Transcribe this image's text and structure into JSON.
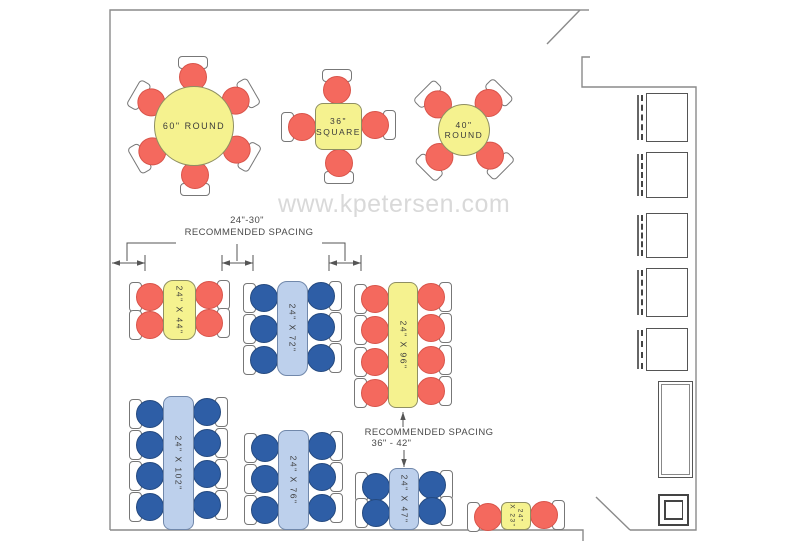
{
  "watermark": {
    "text": "www.kpetersen.com",
    "color": "#d9d9d9"
  },
  "annotations": {
    "top": {
      "line1": "24\"-30\"",
      "line2": "RECOMMENDED SPACING"
    },
    "bottom": {
      "line1": "RECOMMENDED SPACING",
      "line2": "36\" - 42\""
    }
  },
  "colors": {
    "table_yellow": "#f5f28f",
    "table_yellow_border": "#8f8f62",
    "table_blue": "#bdd0ec",
    "table_blue_border": "#7188ab",
    "chair_red": "#f4695e",
    "chair_red_border": "#d9544a",
    "chair_blue": "#2e5ea6",
    "chair_blue_border": "#24497f",
    "wall": "#8a8a8a",
    "dim": "#555555",
    "label": "#3a3a3a"
  },
  "tables": [
    {
      "id": "round-60",
      "shape": "circle",
      "x": 154,
      "y": 86,
      "w": 80,
      "h": 80,
      "color": "yellow",
      "chair_color": "red",
      "label_lines": [
        "60\" ROUND"
      ],
      "rotated": false,
      "font": 9,
      "chairs": [
        {
          "x": 194,
          "y": 76,
          "rot": 90
        },
        {
          "x": 237,
          "y": 101,
          "rot": 150
        },
        {
          "x": 237,
          "y": 151,
          "rot": 210
        },
        {
          "x": 194,
          "y": 176,
          "rot": 270
        },
        {
          "x": 151,
          "y": 151,
          "rot": 330
        },
        {
          "x": 151,
          "y": 101,
          "rot": 30
        }
      ]
    },
    {
      "id": "square-36",
      "shape": "rect",
      "x": 315,
      "y": 103,
      "w": 47,
      "h": 47,
      "radius": 8,
      "color": "yellow",
      "chair_color": "red",
      "label_lines": [
        "36\"",
        "SQUARE"
      ],
      "rotated": false,
      "font": 8.5,
      "chairs": [
        {
          "x": 338,
          "y": 89,
          "rot": 90
        },
        {
          "x": 376,
          "y": 126,
          "rot": 180
        },
        {
          "x": 338,
          "y": 164,
          "rot": 270
        },
        {
          "x": 301,
          "y": 126,
          "rot": 0
        }
      ]
    },
    {
      "id": "round-40",
      "shape": "circle",
      "x": 438,
      "y": 104,
      "w": 52,
      "h": 52,
      "color": "yellow",
      "chair_color": "red",
      "label_lines": [
        "40\"",
        "ROUND"
      ],
      "rotated": false,
      "font": 8.5,
      "chairs": [
        {
          "x": 438,
          "y": 103,
          "rot": 45
        },
        {
          "x": 490,
          "y": 103,
          "rot": 135
        },
        {
          "x": 490,
          "y": 157,
          "rot": 225
        },
        {
          "x": 438,
          "y": 157,
          "rot": 315
        }
      ]
    },
    {
      "id": "rect-44",
      "shape": "rect",
      "x": 163,
      "y": 280,
      "w": 33,
      "h": 60,
      "radius": 10,
      "color": "yellow",
      "chair_color": "red",
      "label_lines": [
        "24\" X 44\""
      ],
      "rotated": true,
      "font": 8.5,
      "chairs": [
        {
          "x": 149,
          "y": 296,
          "rot": 0
        },
        {
          "x": 149,
          "y": 324,
          "rot": 0
        },
        {
          "x": 210,
          "y": 296,
          "rot": 180
        },
        {
          "x": 210,
          "y": 324,
          "rot": 180
        }
      ]
    },
    {
      "id": "rect-72",
      "shape": "rect",
      "x": 277,
      "y": 281,
      "w": 31,
      "h": 95,
      "radius": 10,
      "color": "blue",
      "chair_color": "blue",
      "label_lines": [
        "24\" X 72\""
      ],
      "rotated": true,
      "font": 8.5,
      "chairs": [
        {
          "x": 263,
          "y": 297,
          "rot": 0
        },
        {
          "x": 263,
          "y": 328,
          "rot": 0
        },
        {
          "x": 263,
          "y": 359,
          "rot": 0
        },
        {
          "x": 322,
          "y": 297,
          "rot": 180
        },
        {
          "x": 322,
          "y": 328,
          "rot": 180
        },
        {
          "x": 322,
          "y": 359,
          "rot": 180
        }
      ]
    },
    {
      "id": "rect-96",
      "shape": "rect",
      "x": 388,
      "y": 282,
      "w": 30,
      "h": 126,
      "radius": 8,
      "color": "yellow",
      "chair_color": "red",
      "label_lines": [
        "24\" X 96\""
      ],
      "rotated": true,
      "font": 8.5,
      "chairs": [
        {
          "x": 374,
          "y": 298,
          "rot": 0
        },
        {
          "x": 374,
          "y": 329,
          "rot": 0
        },
        {
          "x": 374,
          "y": 361,
          "rot": 0
        },
        {
          "x": 374,
          "y": 392,
          "rot": 0
        },
        {
          "x": 432,
          "y": 298,
          "rot": 180
        },
        {
          "x": 432,
          "y": 329,
          "rot": 180
        },
        {
          "x": 432,
          "y": 361,
          "rot": 180
        },
        {
          "x": 432,
          "y": 392,
          "rot": 180
        }
      ]
    },
    {
      "id": "rect-102",
      "shape": "rect",
      "x": 163,
      "y": 396,
      "w": 31,
      "h": 134,
      "radius": 8,
      "color": "blue",
      "chair_color": "blue",
      "label_lines": [
        "24\" X 102\""
      ],
      "rotated": true,
      "font": 8.5,
      "chairs": [
        {
          "x": 149,
          "y": 413,
          "rot": 0
        },
        {
          "x": 149,
          "y": 444,
          "rot": 0
        },
        {
          "x": 149,
          "y": 475,
          "rot": 0
        },
        {
          "x": 149,
          "y": 506,
          "rot": 0
        },
        {
          "x": 208,
          "y": 413,
          "rot": 180
        },
        {
          "x": 208,
          "y": 444,
          "rot": 180
        },
        {
          "x": 208,
          "y": 475,
          "rot": 180
        },
        {
          "x": 208,
          "y": 506,
          "rot": 180
        }
      ]
    },
    {
      "id": "rect-76",
      "shape": "rect",
      "x": 278,
      "y": 430,
      "w": 31,
      "h": 100,
      "radius": 8,
      "color": "blue",
      "chair_color": "blue",
      "label_lines": [
        "24\" X 76\""
      ],
      "rotated": true,
      "font": 8.5,
      "chairs": [
        {
          "x": 264,
          "y": 447,
          "rot": 0
        },
        {
          "x": 264,
          "y": 478,
          "rot": 0
        },
        {
          "x": 264,
          "y": 509,
          "rot": 0
        },
        {
          "x": 323,
          "y": 447,
          "rot": 180
        },
        {
          "x": 323,
          "y": 478,
          "rot": 180
        },
        {
          "x": 323,
          "y": 509,
          "rot": 180
        }
      ]
    },
    {
      "id": "rect-47",
      "shape": "rect",
      "x": 389,
      "y": 468,
      "w": 30,
      "h": 62,
      "radius": 8,
      "color": "blue",
      "chair_color": "blue",
      "label_lines": [
        "24\" X 47\""
      ],
      "rotated": true,
      "font": 8.5,
      "chairs": [
        {
          "x": 375,
          "y": 486,
          "rot": 0
        },
        {
          "x": 375,
          "y": 512,
          "rot": 0
        },
        {
          "x": 433,
          "y": 486,
          "rot": 180
        },
        {
          "x": 433,
          "y": 512,
          "rot": 180
        }
      ]
    },
    {
      "id": "rect-23",
      "shape": "rect",
      "x": 501,
      "y": 502,
      "w": 30,
      "h": 28,
      "radius": 6,
      "color": "yellow",
      "chair_color": "red",
      "label_lines": [
        "24\"",
        "X 23\""
      ],
      "rotated": true,
      "font": 6.5,
      "chairs": [
        {
          "x": 487,
          "y": 516,
          "rot": 0
        },
        {
          "x": 545,
          "y": 516,
          "rot": 180
        }
      ]
    }
  ],
  "booths": [
    {
      "x": 646,
      "y": 93,
      "w": 42,
      "h": 49
    },
    {
      "x": 646,
      "y": 152,
      "w": 42,
      "h": 46
    },
    {
      "x": 646,
      "y": 213,
      "w": 42,
      "h": 45
    },
    {
      "x": 646,
      "y": 268,
      "w": 42,
      "h": 49
    },
    {
      "x": 646,
      "y": 328,
      "w": 42,
      "h": 43
    }
  ],
  "fixtures": {
    "counter": {
      "x": 658,
      "y": 381,
      "w": 35,
      "h": 97
    },
    "stand": {
      "x": 658,
      "y": 494,
      "w": 31,
      "h": 32
    }
  },
  "floorplan": {
    "walls": [
      "M110,530 L110,10 L580,10",
      "M580,10 l9,0",
      "M580,10 L547,44",
      "M590,57 L582,57 L582,87 L696,87 L696,530 L630,530",
      "M630,530 L596,497",
      "M110,530 L583,530 L583,541"
    ],
    "dim_arrows": [
      {
        "x1": 112,
        "y1": 263,
        "x2": 145,
        "y2": 263,
        "heads": "both"
      },
      {
        "x1": 222,
        "y1": 263,
        "x2": 253,
        "y2": 263,
        "heads": "both"
      },
      {
        "x1": 329,
        "y1": 263,
        "x2": 361,
        "y2": 263,
        "heads": "both"
      },
      {
        "x1": 403,
        "y1": 427,
        "x2": 403,
        "y2": 412,
        "heads": "end"
      },
      {
        "x1": 404,
        "y1": 450,
        "x2": 404,
        "y2": 467,
        "heads": "end"
      }
    ],
    "ticks": [
      [
        145,
        255,
        145,
        271
      ],
      [
        222,
        255,
        222,
        271
      ],
      [
        253,
        255,
        253,
        271
      ],
      [
        329,
        255,
        329,
        271
      ],
      [
        361,
        255,
        361,
        271
      ]
    ],
    "leaders": [
      "M127,261 L127,243 L176,243",
      "M237,261 L237,244",
      "M322,243 L345,243 L345,261"
    ]
  }
}
